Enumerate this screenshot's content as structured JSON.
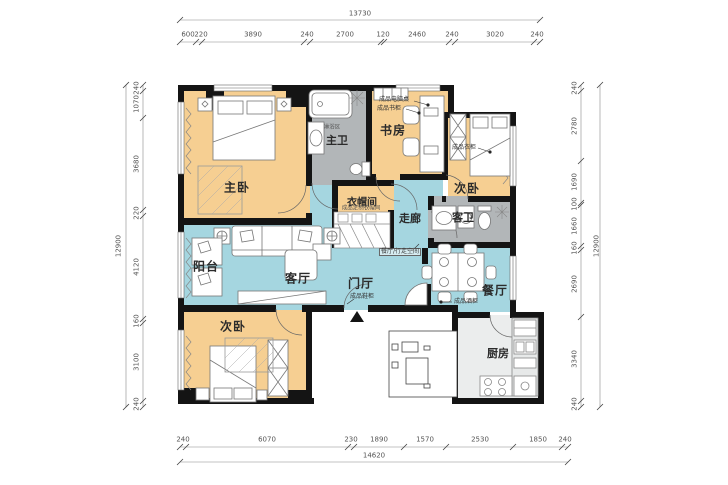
{
  "colors": {
    "bedroom_fill": "#f6cf92",
    "living_fill": "#a5d6e0",
    "bath_fill": "#b2b6b8",
    "kitchen_fill": "#ebeded",
    "wall": "#141414",
    "dimension_text": "#555555"
  },
  "rooms": {
    "master_bedroom": {
      "label": "主卧"
    },
    "master_bath": {
      "label": "主卫"
    },
    "study": {
      "label": "书房"
    },
    "bedroom_ne": {
      "label": "次卧"
    },
    "guest_bath": {
      "label": "客卫"
    },
    "cloakroom": {
      "label": "衣帽间"
    },
    "corridor": {
      "label": "走廊"
    },
    "living_room": {
      "label": "客厅"
    },
    "balcony": {
      "label": "阳台"
    },
    "foyer": {
      "label": "门厅"
    },
    "dining_room": {
      "label": "餐厅"
    },
    "bedroom_sw": {
      "label": "次卧"
    },
    "kitchen": {
      "label": "厨房"
    }
  },
  "annotations": {
    "computer_desk": "成品电脑桌",
    "bookcase": "成品书柜",
    "shower_area": "淋浴区",
    "wardrobe": "成品衣柜",
    "custom_cloakroom": "成品定制衣帽间",
    "walk_space": "餐厅/行走空间",
    "shoe_cabinet": "成品鞋柜",
    "wine_cabinet": "成品酒柜"
  },
  "dimensions": {
    "top": {
      "overall": "13730",
      "segments": [
        "600",
        "220",
        "3890",
        "240",
        "2700",
        "120",
        "2460",
        "240",
        "3020",
        "240"
      ]
    },
    "bottom": {
      "overall": "14620",
      "segments": [
        "240",
        "6070",
        "230",
        "1890",
        "1570",
        "2530",
        "1850",
        "240"
      ]
    },
    "left": {
      "overall": "12900",
      "segments": [
        "240",
        "1070",
        "3680",
        "220",
        "4120",
        "160",
        "3100",
        "240"
      ]
    },
    "right": {
      "overall": "12900",
      "segments": [
        "240",
        "2780",
        "1690",
        "100",
        "1660",
        "160",
        "2690",
        "3340",
        "240"
      ]
    }
  }
}
